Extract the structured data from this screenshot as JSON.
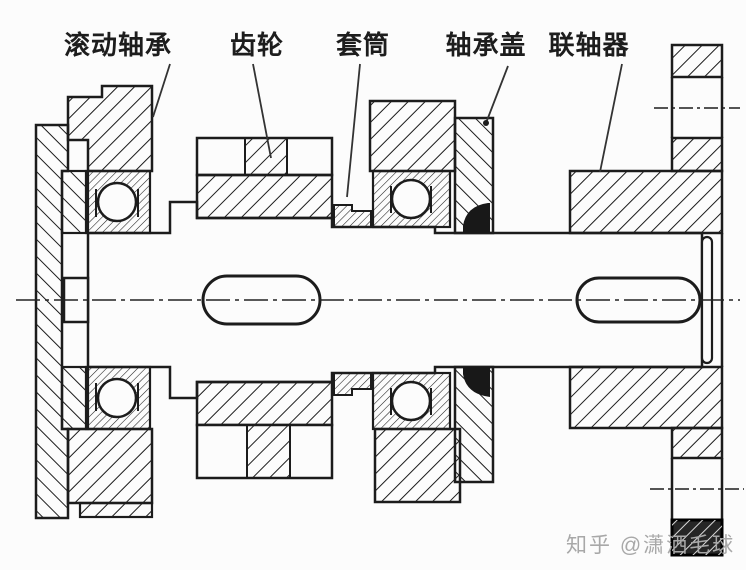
{
  "diagram": {
    "type": "mechanical-shaft-assembly-section",
    "labels": [
      {
        "id": "rolling-bearing",
        "text": "滚动轴承"
      },
      {
        "id": "gear",
        "text": "齿轮"
      },
      {
        "id": "sleeve",
        "text": "套筒"
      },
      {
        "id": "bearing-cover",
        "text": "轴承盖"
      },
      {
        "id": "coupling",
        "text": "联轴器"
      }
    ],
    "watermark": {
      "text": "知乎 @潇洒毛球"
    },
    "colors": {
      "line": "#1c1c1c",
      "background": "#fcfcfc",
      "seal": "#181818",
      "dark_block": "#262626",
      "watermark": "#a8a8a8"
    }
  }
}
